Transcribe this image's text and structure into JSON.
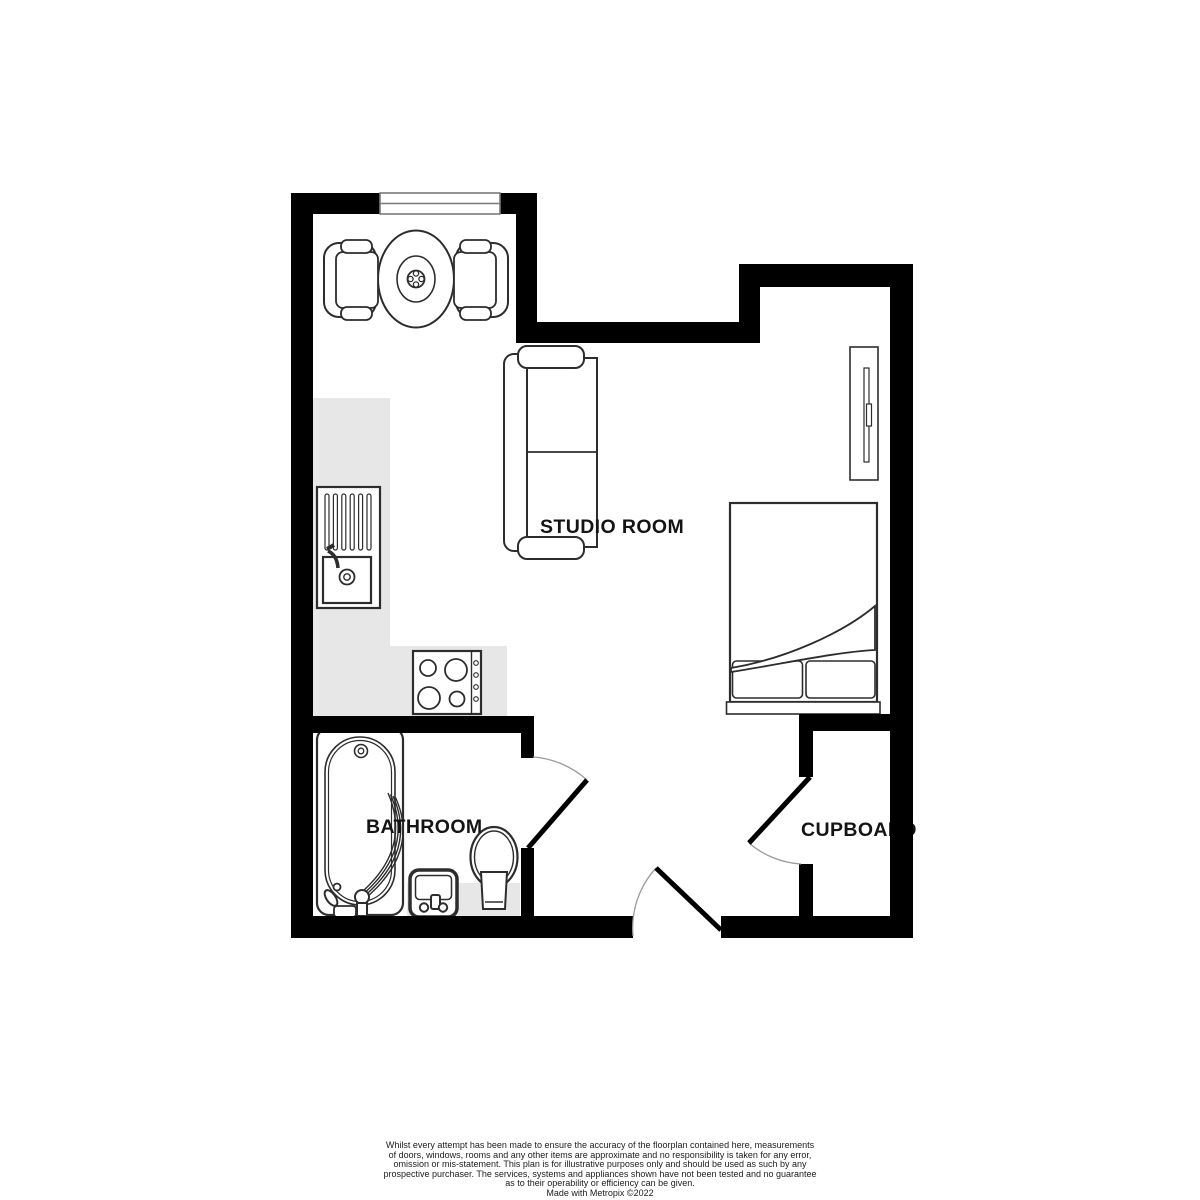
{
  "floorplan": {
    "labels": {
      "studio": "STUDIO ROOM",
      "bathroom": "BATHROOM",
      "cupboard": "CUPBOARD"
    },
    "colors": {
      "wall": "#000000",
      "floor_highlight": "#e7e7e7",
      "furniture_stroke": "#2d2d2d",
      "label_text": "#141414",
      "door_arc": "#9a9a9a",
      "window_frame": "#7a7a7a"
    },
    "furniture_icons": [
      "window-icon",
      "round-dining-table-icon",
      "dining-chair-icon",
      "sofa-icon",
      "wardrobe-icon",
      "double-bed-icon",
      "pillow-icon",
      "kitchen-sink-drainer-icon",
      "hob-icon",
      "bath-icon",
      "washbasin-icon",
      "toilet-icon",
      "door-swing-icon"
    ]
  },
  "disclaimer": {
    "lines": [
      "Whilst every attempt has been made to ensure the accuracy of the floorplan contained here, measurements",
      "of doors, windows, rooms and any other items are approximate and no responsibility is taken for any error,",
      "omission or mis-statement. This plan is for illustrative purposes only and should be used as such by any",
      "prospective purchaser. The services, systems and appliances shown have not been tested and no guarantee",
      "as to their operability or efficiency can be given.",
      "Made with Metropix ©2022"
    ]
  }
}
